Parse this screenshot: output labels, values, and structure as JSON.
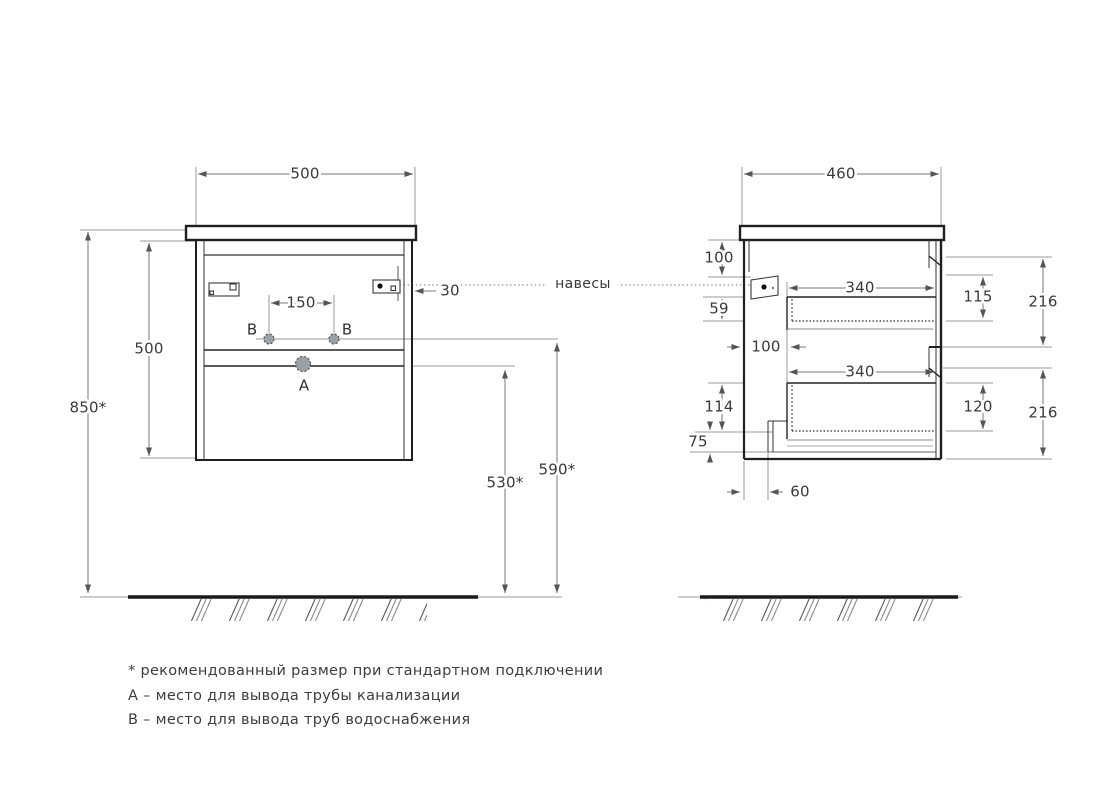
{
  "drawing": {
    "front_view": {
      "width_top": "500",
      "cabinet_height": "500",
      "floor_to_top": "850*",
      "holes_spacing": "150",
      "hole_b_label": "B",
      "hole_a_label": "A",
      "hanger_edge_offset": "30",
      "floor_to_divider": "530*",
      "floor_to_b_holes": "590*"
    },
    "hangers_label": "навесы",
    "side_view": {
      "depth_top": "460",
      "top_to_hanger": "100",
      "hanger_to_drawer": "59",
      "back_to_drawer": "100",
      "drawer_depth_top": "340",
      "drawer_depth_bottom": "340",
      "drawer_inner_top": "115",
      "drawer_inner_bottom": "120",
      "front_panel_top": "216",
      "front_panel_bottom": "216",
      "lower_clearance": "114",
      "recess_height": "75",
      "recess_width": "60"
    },
    "notes": [
      "* рекомендованный размер при стандартном подключении",
      "А – место для вывода трубы канализации",
      "В – место для вывода труб водоснабжения"
    ],
    "colors": {
      "line": "#1f1f1f",
      "dimension": "#777777",
      "hole_fill": "#9aa1a8",
      "background": "#ffffff"
    }
  }
}
